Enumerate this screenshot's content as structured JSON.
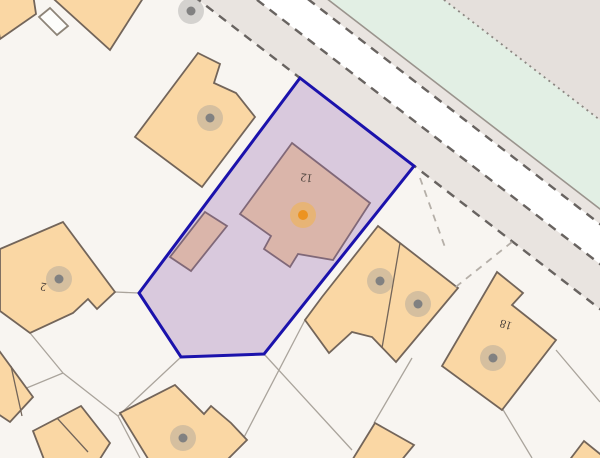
{
  "map": {
    "width": 600,
    "height": 458,
    "colors": {
      "background": "#f8f5f1",
      "building_fill": "#fad7a4",
      "building_stroke": "#73655a",
      "shed_fill": "#fdfdfb",
      "shed_stroke": "#8d8478",
      "pavement_fill": "#e9e4e0",
      "carriageway_fill": "#ffffff",
      "verge_green_fill": "#e2efe4",
      "far_corner_fill": "#e5e0dc",
      "road_dash_stroke": "#686360",
      "road_solid_stroke": "#9a948d",
      "road_dotted_stroke": "#8b8681",
      "plot_line_stroke": "#aaa49c",
      "plot_dash_stroke": "#b5afa8",
      "parcel_fill_rgba": "rgba(155,112,182,0.33)",
      "parcel_stroke": "#1b12ac",
      "selected_marker_inner": "#ec9320",
      "selected_marker_halo": "#f2b24b",
      "building_marker_inner": "#818181",
      "building_marker_halo": "#999999",
      "label_color": "#4c423c"
    },
    "road_bands": [
      {
        "name": "near-pavement",
        "fill_key": "pavement_fill",
        "points": [
          [
            -60,
            -199.2
          ],
          [
            660,
            355.2
          ],
          [
            660,
            310.2
          ],
          [
            -60,
            -244.2
          ]
        ]
      },
      {
        "name": "carriageway",
        "fill_key": "carriageway_fill",
        "points": [
          [
            -60,
            -244.2
          ],
          [
            660,
            310.2
          ],
          [
            660,
            270.2
          ],
          [
            -60,
            -284.2
          ]
        ]
      },
      {
        "name": "far-pavement",
        "fill_key": "pavement_fill",
        "points": [
          [
            -60,
            -284.2
          ],
          [
            660,
            270.2
          ],
          [
            660,
            255.2
          ],
          [
            -60,
            -299.2
          ]
        ]
      },
      {
        "name": "grass-verge",
        "fill_key": "verge_green_fill",
        "points": [
          [
            -60,
            -299.2
          ],
          [
            660,
            255.2
          ],
          [
            660,
            166.2
          ],
          [
            -60,
            -388.2
          ]
        ]
      },
      {
        "name": "far-corner",
        "fill_key": "far_corner_fill",
        "points": [
          [
            -60,
            -388.2
          ],
          [
            660,
            166.2
          ],
          [
            660,
            -500
          ],
          [
            -60,
            -500
          ]
        ]
      }
    ],
    "road_lines": [
      {
        "name": "kerb-near-dashed",
        "x1": -60,
        "y1": -199.2,
        "x2": 660,
        "y2": 355.2,
        "style": "dash"
      },
      {
        "name": "kerb-mid-dashed",
        "x1": -60,
        "y1": -244.2,
        "x2": 660,
        "y2": 310.2,
        "style": "dash"
      },
      {
        "name": "kerb-far-dashed",
        "x1": -60,
        "y1": -284.2,
        "x2": 660,
        "y2": 270.2,
        "style": "dash"
      },
      {
        "name": "verge-solid",
        "x1": -60,
        "y1": -299.2,
        "x2": 660,
        "y2": 255.2,
        "style": "solid"
      },
      {
        "name": "verge-dotted",
        "x1": -60,
        "y1": -388.2,
        "x2": 660,
        "y2": 166.2,
        "style": "dot"
      }
    ],
    "plot_lines": [
      [
        115,
        292,
        139,
        293
      ],
      [
        30,
        333,
        63,
        373
      ],
      [
        63,
        373,
        0,
        399
      ],
      [
        181,
        357,
        118,
        416
      ],
      [
        118,
        416,
        63,
        373
      ],
      [
        118,
        416,
        140,
        458
      ],
      [
        264,
        354,
        352,
        450
      ],
      [
        305,
        320,
        240,
        445
      ],
      [
        412,
        358,
        374,
        423
      ],
      [
        556,
        350,
        600,
        402
      ],
      [
        502,
        408,
        532,
        458
      ]
    ],
    "dashed_plot_lines": [
      [
        420,
        178,
        446,
        250
      ],
      [
        512,
        242,
        452,
        290
      ]
    ],
    "buildings": [
      {
        "name": "building-top-left",
        "kind": "tan",
        "points": [
          [
            -8,
            -8
          ],
          [
            33,
            -6
          ],
          [
            36,
            14
          ],
          [
            0,
            39
          ]
        ]
      },
      {
        "name": "building-top-center",
        "kind": "tan",
        "points": [
          [
            46,
            -8
          ],
          [
            147,
            -8
          ],
          [
            110,
            50
          ]
        ]
      },
      {
        "name": "shed-top-left",
        "kind": "shed",
        "points": [
          [
            50,
            8
          ],
          [
            68,
            26
          ],
          [
            57,
            35
          ],
          [
            39,
            17
          ]
        ]
      },
      {
        "name": "building-northwest",
        "kind": "tan",
        "points": [
          [
            198,
            53
          ],
          [
            220,
            64
          ],
          [
            214,
            83
          ],
          [
            236,
            93
          ],
          [
            255,
            117
          ],
          [
            202,
            187
          ],
          [
            135,
            137
          ]
        ]
      },
      {
        "name": "building-no-2",
        "kind": "tan",
        "points": [
          [
            63,
            222
          ],
          [
            115,
            292
          ],
          [
            97,
            309
          ],
          [
            88,
            299
          ],
          [
            73,
            313
          ],
          [
            30,
            333
          ],
          [
            0,
            311
          ],
          [
            0,
            249
          ]
        ]
      },
      {
        "name": "annex-in-parcel",
        "kind": "tan",
        "points": [
          [
            205,
            212
          ],
          [
            227,
            226
          ],
          [
            191,
            271
          ],
          [
            170,
            257
          ]
        ]
      },
      {
        "name": "building-no-12",
        "kind": "tan",
        "points": [
          [
            292,
            143
          ],
          [
            370,
            203
          ],
          [
            333,
            260
          ],
          [
            298,
            254
          ],
          [
            290,
            267
          ],
          [
            264,
            249
          ],
          [
            271,
            236
          ],
          [
            240,
            214
          ]
        ]
      },
      {
        "name": "building-semis",
        "kind": "tan",
        "points": [
          [
            378,
            226
          ],
          [
            458,
            288
          ],
          [
            396,
            362
          ],
          [
            372,
            337
          ],
          [
            352,
            332
          ],
          [
            329,
            353
          ],
          [
            305,
            320
          ],
          [
            322,
            297
          ]
        ]
      },
      {
        "name": "building-no-18",
        "kind": "tan",
        "points": [
          [
            497,
            272
          ],
          [
            523,
            293
          ],
          [
            512,
            305
          ],
          [
            531,
            320
          ],
          [
            556,
            340
          ],
          [
            502,
            410
          ],
          [
            442,
            366
          ]
        ]
      },
      {
        "name": "building-bottom-center",
        "kind": "tan",
        "points": [
          [
            175,
            385
          ],
          [
            204,
            414
          ],
          [
            211,
            406
          ],
          [
            231,
            423
          ],
          [
            247,
            440
          ],
          [
            225,
            462
          ],
          [
            150,
            462
          ],
          [
            120,
            413
          ]
        ]
      },
      {
        "name": "garage-left",
        "kind": "tan",
        "points": [
          [
            -5,
            345
          ],
          [
            33,
            397
          ],
          [
            10,
            422
          ],
          [
            -5,
            412
          ]
        ]
      },
      {
        "name": "garage-pair",
        "kind": "tan",
        "points": [
          [
            33,
            431
          ],
          [
            81,
            406
          ],
          [
            110,
            443
          ],
          [
            98,
            462
          ],
          [
            45,
            462
          ]
        ]
      },
      {
        "name": "building-bottom-right",
        "kind": "tan",
        "points": [
          [
            375,
            423
          ],
          [
            414,
            445
          ],
          [
            400,
            462
          ],
          [
            351,
            462
          ]
        ]
      },
      {
        "name": "building-corner-se",
        "kind": "tan",
        "points": [
          [
            568,
            462
          ],
          [
            584,
            441
          ],
          [
            605,
            458
          ],
          [
            605,
            462
          ]
        ]
      }
    ],
    "building_dividers": [
      [
        400,
        243,
        382,
        348
      ],
      [
        57,
        418,
        88,
        452
      ],
      [
        11,
        366,
        22,
        416
      ]
    ],
    "parcel": {
      "name": "selected-parcel",
      "points": [
        [
          300,
          78
        ],
        [
          414,
          166
        ],
        [
          264,
          354
        ],
        [
          181,
          357
        ],
        [
          139,
          293
        ]
      ]
    },
    "labels": [
      {
        "text": "12",
        "x": 307,
        "y": 174,
        "rot": 188,
        "size": 12
      },
      {
        "text": "2",
        "x": 44,
        "y": 283,
        "rot": 190,
        "size": 12
      },
      {
        "text": "18",
        "x": 507,
        "y": 321,
        "rot": 197,
        "size": 12
      }
    ],
    "building_markers": [
      {
        "x": 191,
        "y": 11
      },
      {
        "x": 210,
        "y": 118
      },
      {
        "x": 59,
        "y": 279
      },
      {
        "x": 380,
        "y": 281
      },
      {
        "x": 418,
        "y": 304
      },
      {
        "x": 493,
        "y": 358
      },
      {
        "x": 183,
        "y": 438
      }
    ],
    "selected_marker": {
      "x": 303,
      "y": 215
    }
  }
}
